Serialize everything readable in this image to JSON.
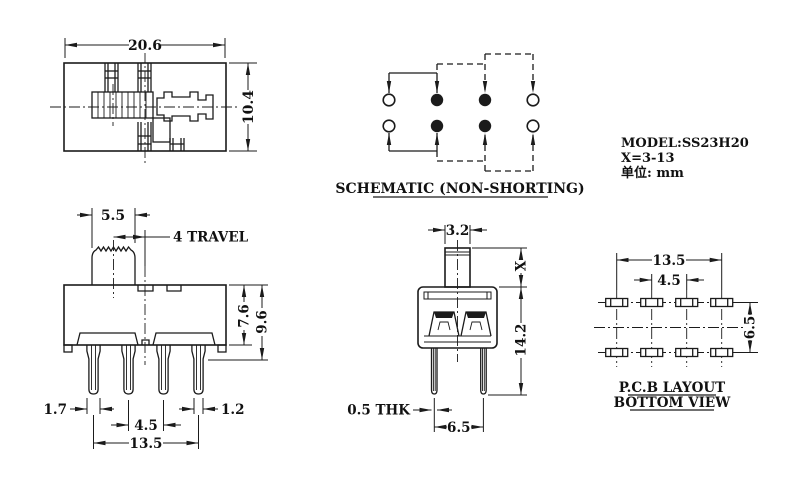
{
  "drawing": {
    "model_block": {
      "line1": "MODEL:SS23H20",
      "line2": "X=3-13",
      "line3": "单位: mm"
    },
    "schematic": {
      "title": "SCHEMATIC (NON-SHORTING)"
    },
    "pcb": {
      "title1": "P.C.B LAYOUT",
      "title2": "BOTTOM VIEW",
      "dim_outer_pitch": "13.5",
      "dim_inner_pitch": "4.5",
      "dim_row_pitch": "6.5"
    },
    "top_view": {
      "dim_width": "20.6",
      "dim_height": "10.4"
    },
    "front_view": {
      "dim_knob_width": "5.5",
      "dim_travel": "4 TRAVEL",
      "dim_body_height": "7.6",
      "dim_total_height": "9.6",
      "dim_pin1_width": "1.7",
      "dim_pin4_width": "1.2",
      "dim_inner_pitch": "4.5",
      "dim_outer_pitch": "13.5"
    },
    "side_view": {
      "dim_stem_width": "3.2",
      "dim_stem_height": "X",
      "dim_total_height": "14.2",
      "dim_pin_thickness": "0.5 THK",
      "dim_pin_pitch": "6.5"
    }
  },
  "colors": {
    "ink": "#1b1b1b",
    "paper": "#ffffff"
  }
}
